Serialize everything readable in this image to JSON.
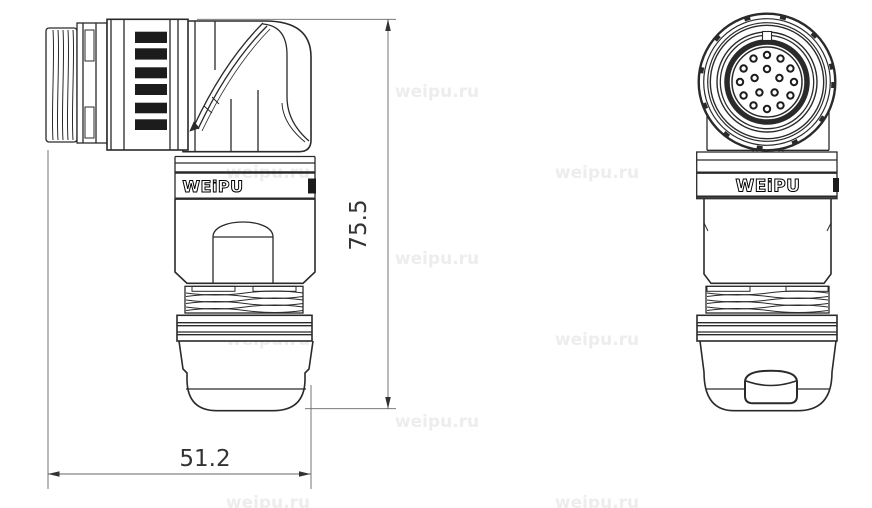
{
  "title": "WEIPU right-angle circular connector technical drawing",
  "logo": {
    "text": "WEiPU"
  },
  "dimensions": {
    "height": {
      "value": "75.5"
    },
    "length": {
      "value": "51.2"
    }
  },
  "watermark": {
    "text": "weipu.ru",
    "color": "#ededed",
    "font_size": 17,
    "positions": [
      [
        437,
        97
      ],
      [
        268,
        178
      ],
      [
        597,
        178
      ],
      [
        437,
        264
      ],
      [
        268,
        345
      ],
      [
        597,
        345
      ],
      [
        437,
        427
      ],
      [
        268,
        508
      ],
      [
        597,
        508
      ]
    ]
  },
  "front_view": {
    "pin_holes": {
      "center_x": 767,
      "center_y": 82,
      "insert_radius": 35,
      "hole_radius": 3.2,
      "outer_count": 12,
      "outer_ring_radius": 27,
      "inner_count": 5,
      "inner_ring_radius": 13,
      "total": 17
    }
  },
  "colors": {
    "line": "#2a2a2a",
    "background": "#ffffff",
    "dim_line": "#666666"
  }
}
